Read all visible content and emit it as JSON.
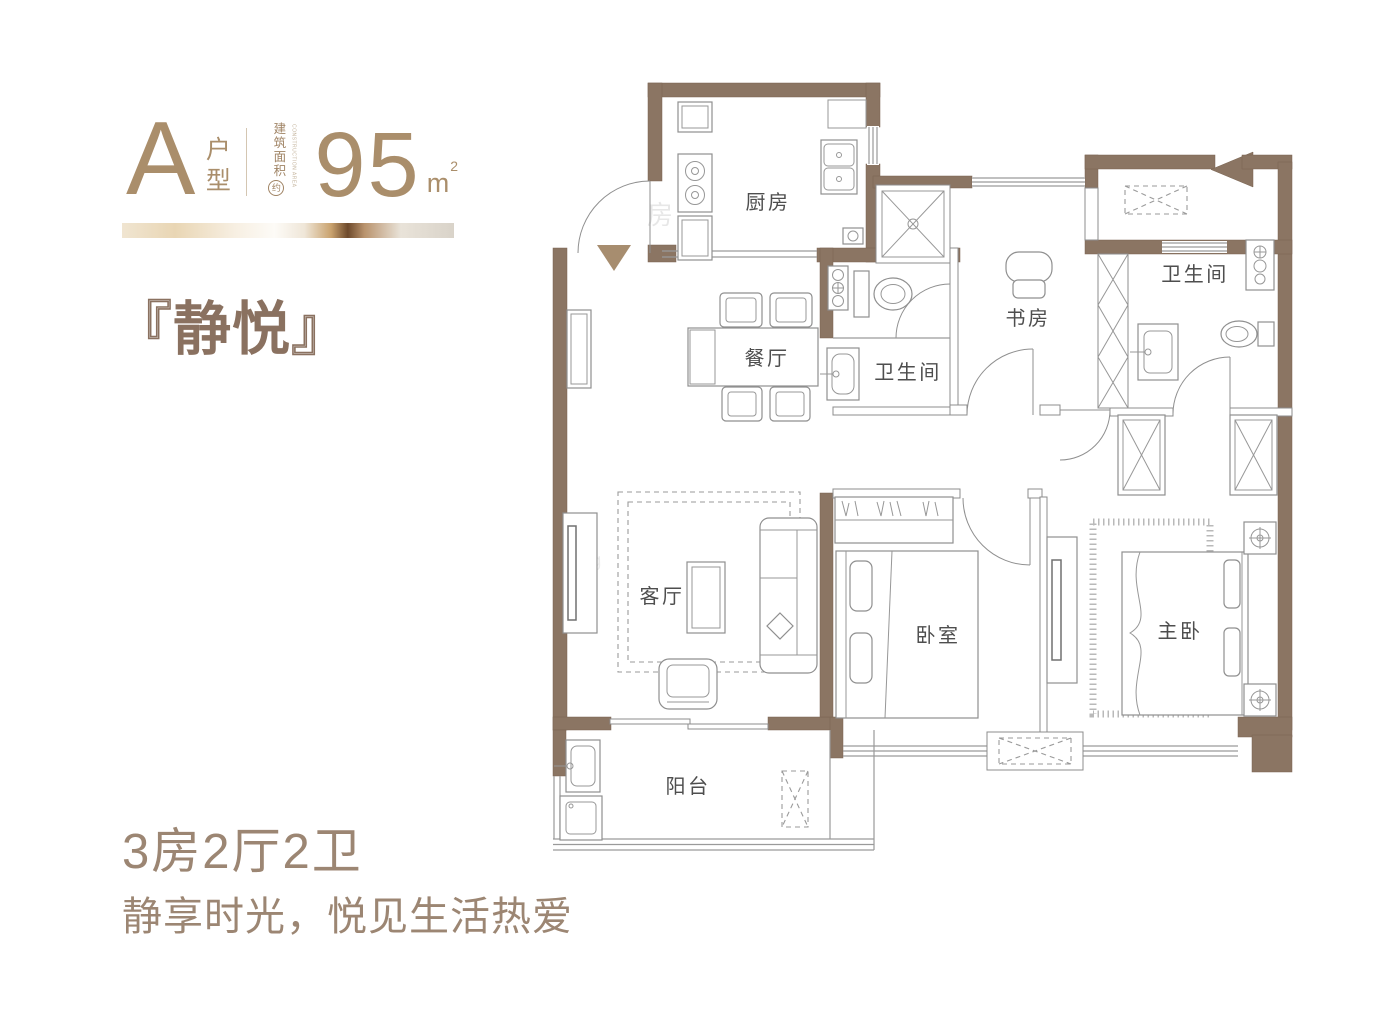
{
  "header": {
    "type_letter": "A",
    "type_label": "户型",
    "area_label": "建筑面积",
    "area_label_en": "CONSTRUCTION AREA",
    "area_qualifier": "约",
    "area_value": "95",
    "area_unit": "m",
    "area_unit_exponent": "2"
  },
  "title": {
    "bracket_open": "『",
    "name": "静悦",
    "bracket_close": "』"
  },
  "summary": {
    "layout": "3房2厅2卫",
    "slogan": "静享时光，悦见生活热爱"
  },
  "floorplan": {
    "rooms": {
      "kitchen": "厨房",
      "dining": "餐厅",
      "bathroom1": "卫生间",
      "study": "书房",
      "bathroom2": "卫生间",
      "living": "客厅",
      "bedroom": "卧室",
      "master_bedroom": "主卧",
      "balcony": "阳台"
    },
    "watermarks": [
      "房",
      "Fang"
    ]
  },
  "colors": {
    "wall_brown": "#8b7563",
    "accent_gold": "#aa8e6b",
    "title_brown": "#8a7160",
    "text_brown": "#9c8673",
    "line_gray": "#8f8f8f"
  }
}
